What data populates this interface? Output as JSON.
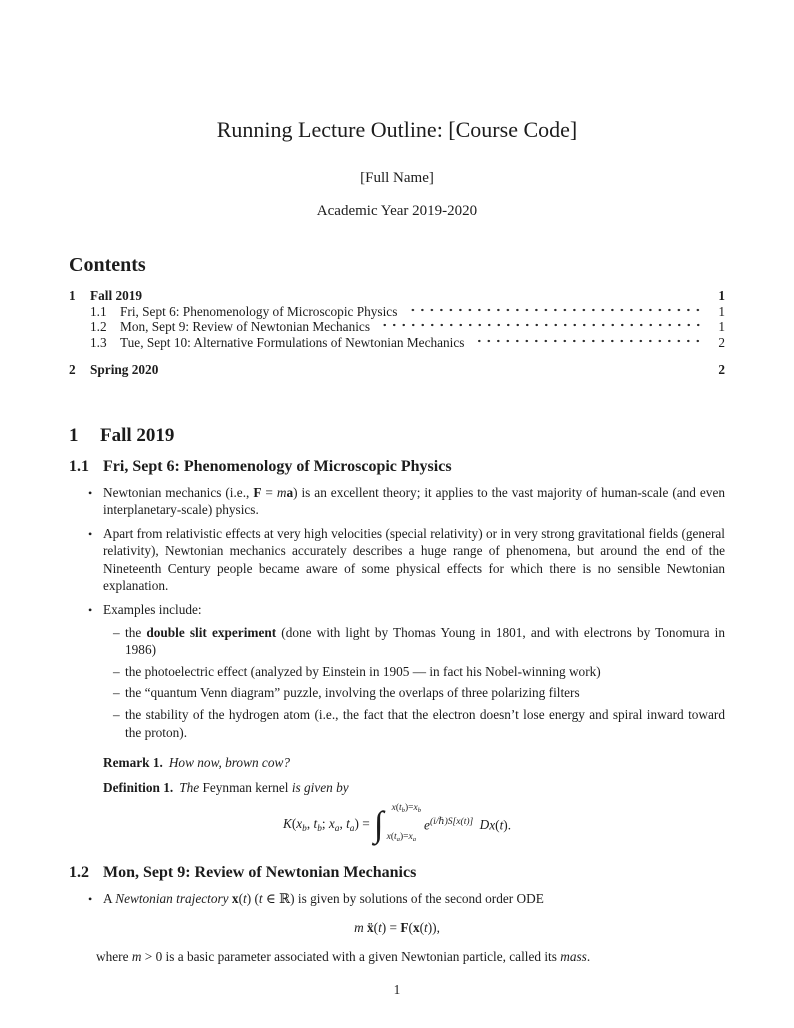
{
  "colors": {
    "background": "#ffffff",
    "text": "#1c1c1c"
  },
  "header": {
    "title": "Running Lecture Outline: [Course Code]",
    "author": "[Full Name]",
    "date": "Academic Year 2019-2020"
  },
  "toc": {
    "heading": "Contents",
    "entries": [
      {
        "number": "1",
        "title": "Fall 2019",
        "page": "1"
      },
      {
        "number": "1.1",
        "title": "Fri, Sept 6: Phenomenology of Microscopic Physics",
        "page": "1"
      },
      {
        "number": "1.2",
        "title": "Mon, Sept 9: Review of Newtonian Mechanics",
        "page": "1"
      },
      {
        "number": "1.3",
        "title": "Tue, Sept 10: Alternative Formulations of Newtonian Mechanics",
        "page": "2"
      },
      {
        "number": "2",
        "title": "Spring 2020",
        "page": "2"
      }
    ]
  },
  "sections": {
    "fall": {
      "number": "1",
      "title": "Fall 2019"
    },
    "s11": {
      "number": "1.1",
      "title": "Fri, Sept 6: Phenomenology of Microscopic Physics",
      "bullets": {
        "b1": [
          {
            "t": "Newtonian mechanics (i.e., "
          },
          {
            "t": "F",
            "c": "bf"
          },
          {
            "t": " = "
          },
          {
            "t": "m",
            "c": "it"
          },
          {
            "t": "a",
            "c": "bf"
          },
          {
            "t": ") is an excellent theory; it applies to the vast majority of human-scale (and even interplanetary-scale) physics."
          }
        ],
        "b2": [
          {
            "t": "Apart from relativistic effects at very high velocities (special relativity) or in very strong gravitational fields (general relativity), Newtonian mechanics accurately describes a huge range of phenomena, but around the end of the Nineteenth Century people became aware of some physical effects for which there is no sensible Newtonian explanation."
          }
        ],
        "b3": [
          {
            "t": "Examples include:"
          }
        ]
      },
      "subitems": {
        "s1": [
          {
            "t": "the "
          },
          {
            "t": "double slit experiment",
            "c": "bf"
          },
          {
            "t": " (done with light by Thomas Young in 1801, and with electrons by Tonomura in 1986)"
          }
        ],
        "s2": [
          {
            "t": "the photoelectric effect (analyzed by Einstein in 1905 — in fact his Nobel-winning work)"
          }
        ],
        "s3": [
          {
            "t": "the “quantum Venn diagram” puzzle, involving the overlaps of three polarizing filters"
          }
        ],
        "s4": [
          {
            "t": "the stability of the hydrogen atom (i.e., the fact that the electron doesn’t lose energy and spiral inward toward the proton)."
          }
        ]
      },
      "remark": {
        "label": "Remark 1.",
        "body": [
          {
            "t": "How now, brown cow?",
            "c": "it"
          }
        ]
      },
      "definition": {
        "label": "Definition 1.",
        "body": [
          {
            "t": "The ",
            "c": "it"
          },
          {
            "t": "Feynman kernel"
          },
          {
            "t": " is given by",
            "c": "it"
          }
        ]
      }
    },
    "s12": {
      "number": "1.2",
      "title": "Mon, Sept 9: Review of Newtonian Mechanics",
      "b1": [
        {
          "t": "A "
        },
        {
          "t": "Newtonian trajectory",
          "c": "it"
        },
        {
          "t": " "
        },
        {
          "t": "x",
          "c": "bf"
        },
        {
          "t": "("
        },
        {
          "t": "t",
          "c": "it"
        },
        {
          "t": ") ("
        },
        {
          "t": "t",
          "c": "it"
        },
        {
          "t": " ∈ ℝ) is given by solutions of the second order ODE"
        }
      ],
      "after": [
        {
          "t": "where "
        },
        {
          "t": "m",
          "c": "it"
        },
        {
          "t": " > 0 is a basic parameter associated with a given Newtonian particle, called its "
        },
        {
          "t": "mass",
          "c": "it"
        },
        {
          "t": "."
        }
      ]
    }
  },
  "math": {
    "kernel": {
      "lhs": [
        {
          "t": "K",
          "c": "it"
        },
        {
          "t": "("
        },
        {
          "t": "x",
          "c": "it"
        },
        {
          "t": "b",
          "c": "sub"
        },
        {
          "t": ", "
        },
        {
          "t": "t",
          "c": "it"
        },
        {
          "t": "b",
          "c": "sub"
        },
        {
          "t": "; "
        },
        {
          "t": "x",
          "c": "it"
        },
        {
          "t": "a",
          "c": "sub"
        },
        {
          "t": ", "
        },
        {
          "t": "t",
          "c": "it"
        },
        {
          "t": "a",
          "c": "sub"
        },
        {
          "t": ") = "
        }
      ],
      "integral_sign": "∫",
      "upper_limit": [
        {
          "t": "x",
          "c": "it"
        },
        {
          "t": "("
        },
        {
          "t": "t",
          "c": "it"
        },
        {
          "t": "b",
          "c": "sub"
        },
        {
          "t": ")="
        },
        {
          "t": "x",
          "c": "it"
        },
        {
          "t": "b",
          "c": "sub"
        }
      ],
      "lower_limit": [
        {
          "t": "x",
          "c": "it"
        },
        {
          "t": "("
        },
        {
          "t": "t",
          "c": "it"
        },
        {
          "t": "a",
          "c": "sub"
        },
        {
          "t": ")="
        },
        {
          "t": "x",
          "c": "it"
        },
        {
          "t": "a",
          "c": "sub"
        }
      ],
      "integrand": [
        {
          "t": "e",
          "c": "it"
        },
        {
          "t": "(i/ℏ)S[x(t)]",
          "c": "sup"
        },
        {
          "t": " "
        },
        {
          "t": "D",
          "c": "scr"
        },
        {
          "t": "x",
          "c": "it"
        },
        {
          "t": "("
        },
        {
          "t": "t",
          "c": "it"
        },
        {
          "t": ")."
        }
      ]
    },
    "newton": {
      "runs": [
        {
          "t": "m",
          "c": "it"
        },
        {
          "t": " "
        },
        {
          "t": "ẍ",
          "c": "bf"
        },
        {
          "t": "("
        },
        {
          "t": "t",
          "c": "it"
        },
        {
          "t": ") = "
        },
        {
          "t": "F",
          "c": "bf"
        },
        {
          "t": "("
        },
        {
          "t": "x",
          "c": "bf"
        },
        {
          "t": "("
        },
        {
          "t": "t",
          "c": "it"
        },
        {
          "t": ")),"
        }
      ]
    }
  },
  "footer": {
    "page_number": "1"
  }
}
